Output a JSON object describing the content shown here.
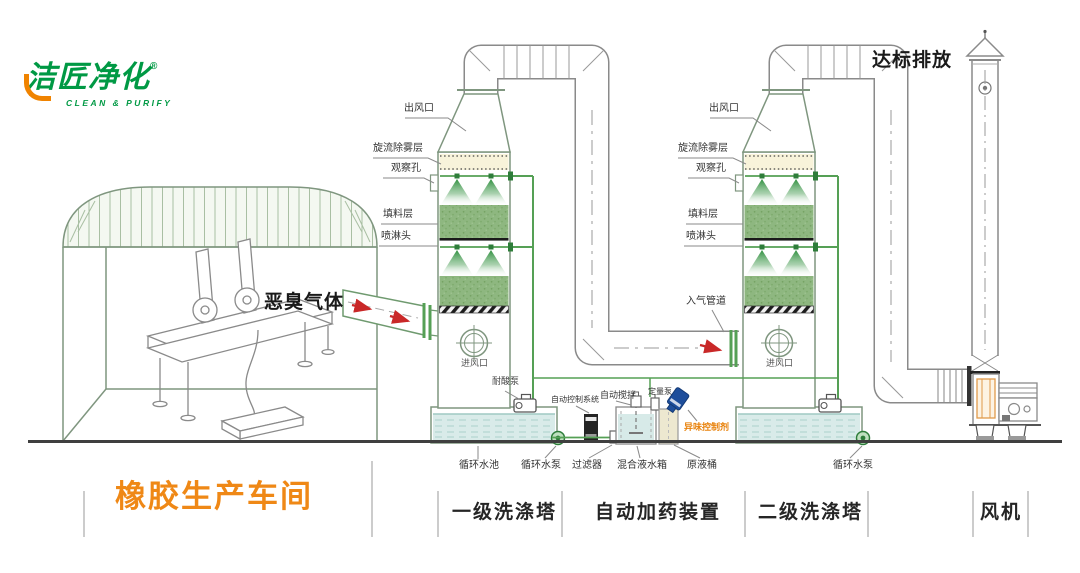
{
  "logo": {
    "brand": "洁匠净化",
    "reg": "®",
    "tagline": "CLEAN & PURIFY"
  },
  "annotations": {
    "odor_gas": "恶臭气体",
    "discharge": "达标排放"
  },
  "tower1_labels": {
    "outlet": "出风口",
    "demister": "旋流除雾层",
    "viewport": "观察孔",
    "packing": "填料层",
    "spray_head": "喷淋头",
    "air_inlet": "进风口",
    "acid_pump": "耐酸泵"
  },
  "tower2_labels": {
    "outlet": "出风口",
    "demister": "旋流除雾层",
    "viewport": "观察孔",
    "packing": "填料层",
    "spray_head": "喷淋头",
    "air_inlet": "进风口",
    "gas_inlet_pipe": "入气管道"
  },
  "equipment_labels": {
    "circ_pool": "循环水池",
    "circ_pump_1": "循环水泵",
    "filter": "过滤器",
    "mix_tank": "混合液水箱",
    "raw_barrel": "原液桶",
    "circ_pump_2": "循环水泵",
    "control_system": "自动控制系统",
    "auto_stirrer": "自动搅拌",
    "metering_pump": "定量泵",
    "odor_agent": "异味控制剂"
  },
  "sections": {
    "workshop": "橡胶生产车间",
    "tower1": "一级洗涤塔",
    "dosing": "自动加药装置",
    "tower2": "二级洗涤塔",
    "fan": "风机"
  },
  "colors": {
    "brand_green": "#009944",
    "brand_orange": "#f08300",
    "workshop_orange": "#ef8816",
    "agent_orange": "#e8820c",
    "arrow_red": "#c92828"
  }
}
